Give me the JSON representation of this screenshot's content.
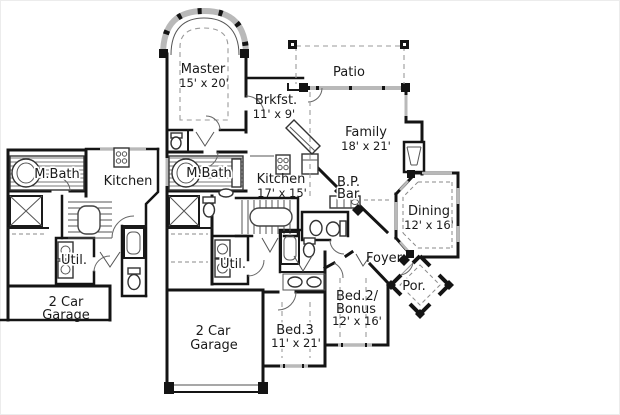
{
  "colors": {
    "background": "#ffffff",
    "wall": "#141414",
    "window_fill": "#b9b9b9",
    "dashed_line": "#9a9a9a",
    "text": "#1a1a1a"
  },
  "left_plan": {
    "mbath_label": "M.Bath",
    "kitchen_label": "Kitchen",
    "util_label": "Util.",
    "garage_label_line1": "2 Car",
    "garage_label_line2": "Garage"
  },
  "main_plan": {
    "master_label": "Master",
    "master_dims": "15' x 20'",
    "patio_label": "Patio",
    "brkfst_label": "Brkfst.",
    "brkfst_dims": "11' x 9'",
    "family_label": "Family",
    "family_dims": "18' x 21'",
    "mbath_label": "M.Bath",
    "kitchen_label": "Kitchen",
    "kitchen_dims": "17' x 15'",
    "bp_bar_label_line1": "B.P.",
    "bp_bar_label_line2": "Bar",
    "dining_label": "Dining",
    "dining_dims": "12' x 16'",
    "util_label": "Util.",
    "foyer_label": "Foyer",
    "porch_label": "Por.",
    "bed2_label_line1": "Bed.2/",
    "bed2_label_line2": "Bonus",
    "bed2_dims": "12' x 16'",
    "bed3_label": "Bed.3",
    "bed3_dims": "11' x 21'",
    "garage_label_line1": "2 Car",
    "garage_label_line2": "Garage"
  }
}
